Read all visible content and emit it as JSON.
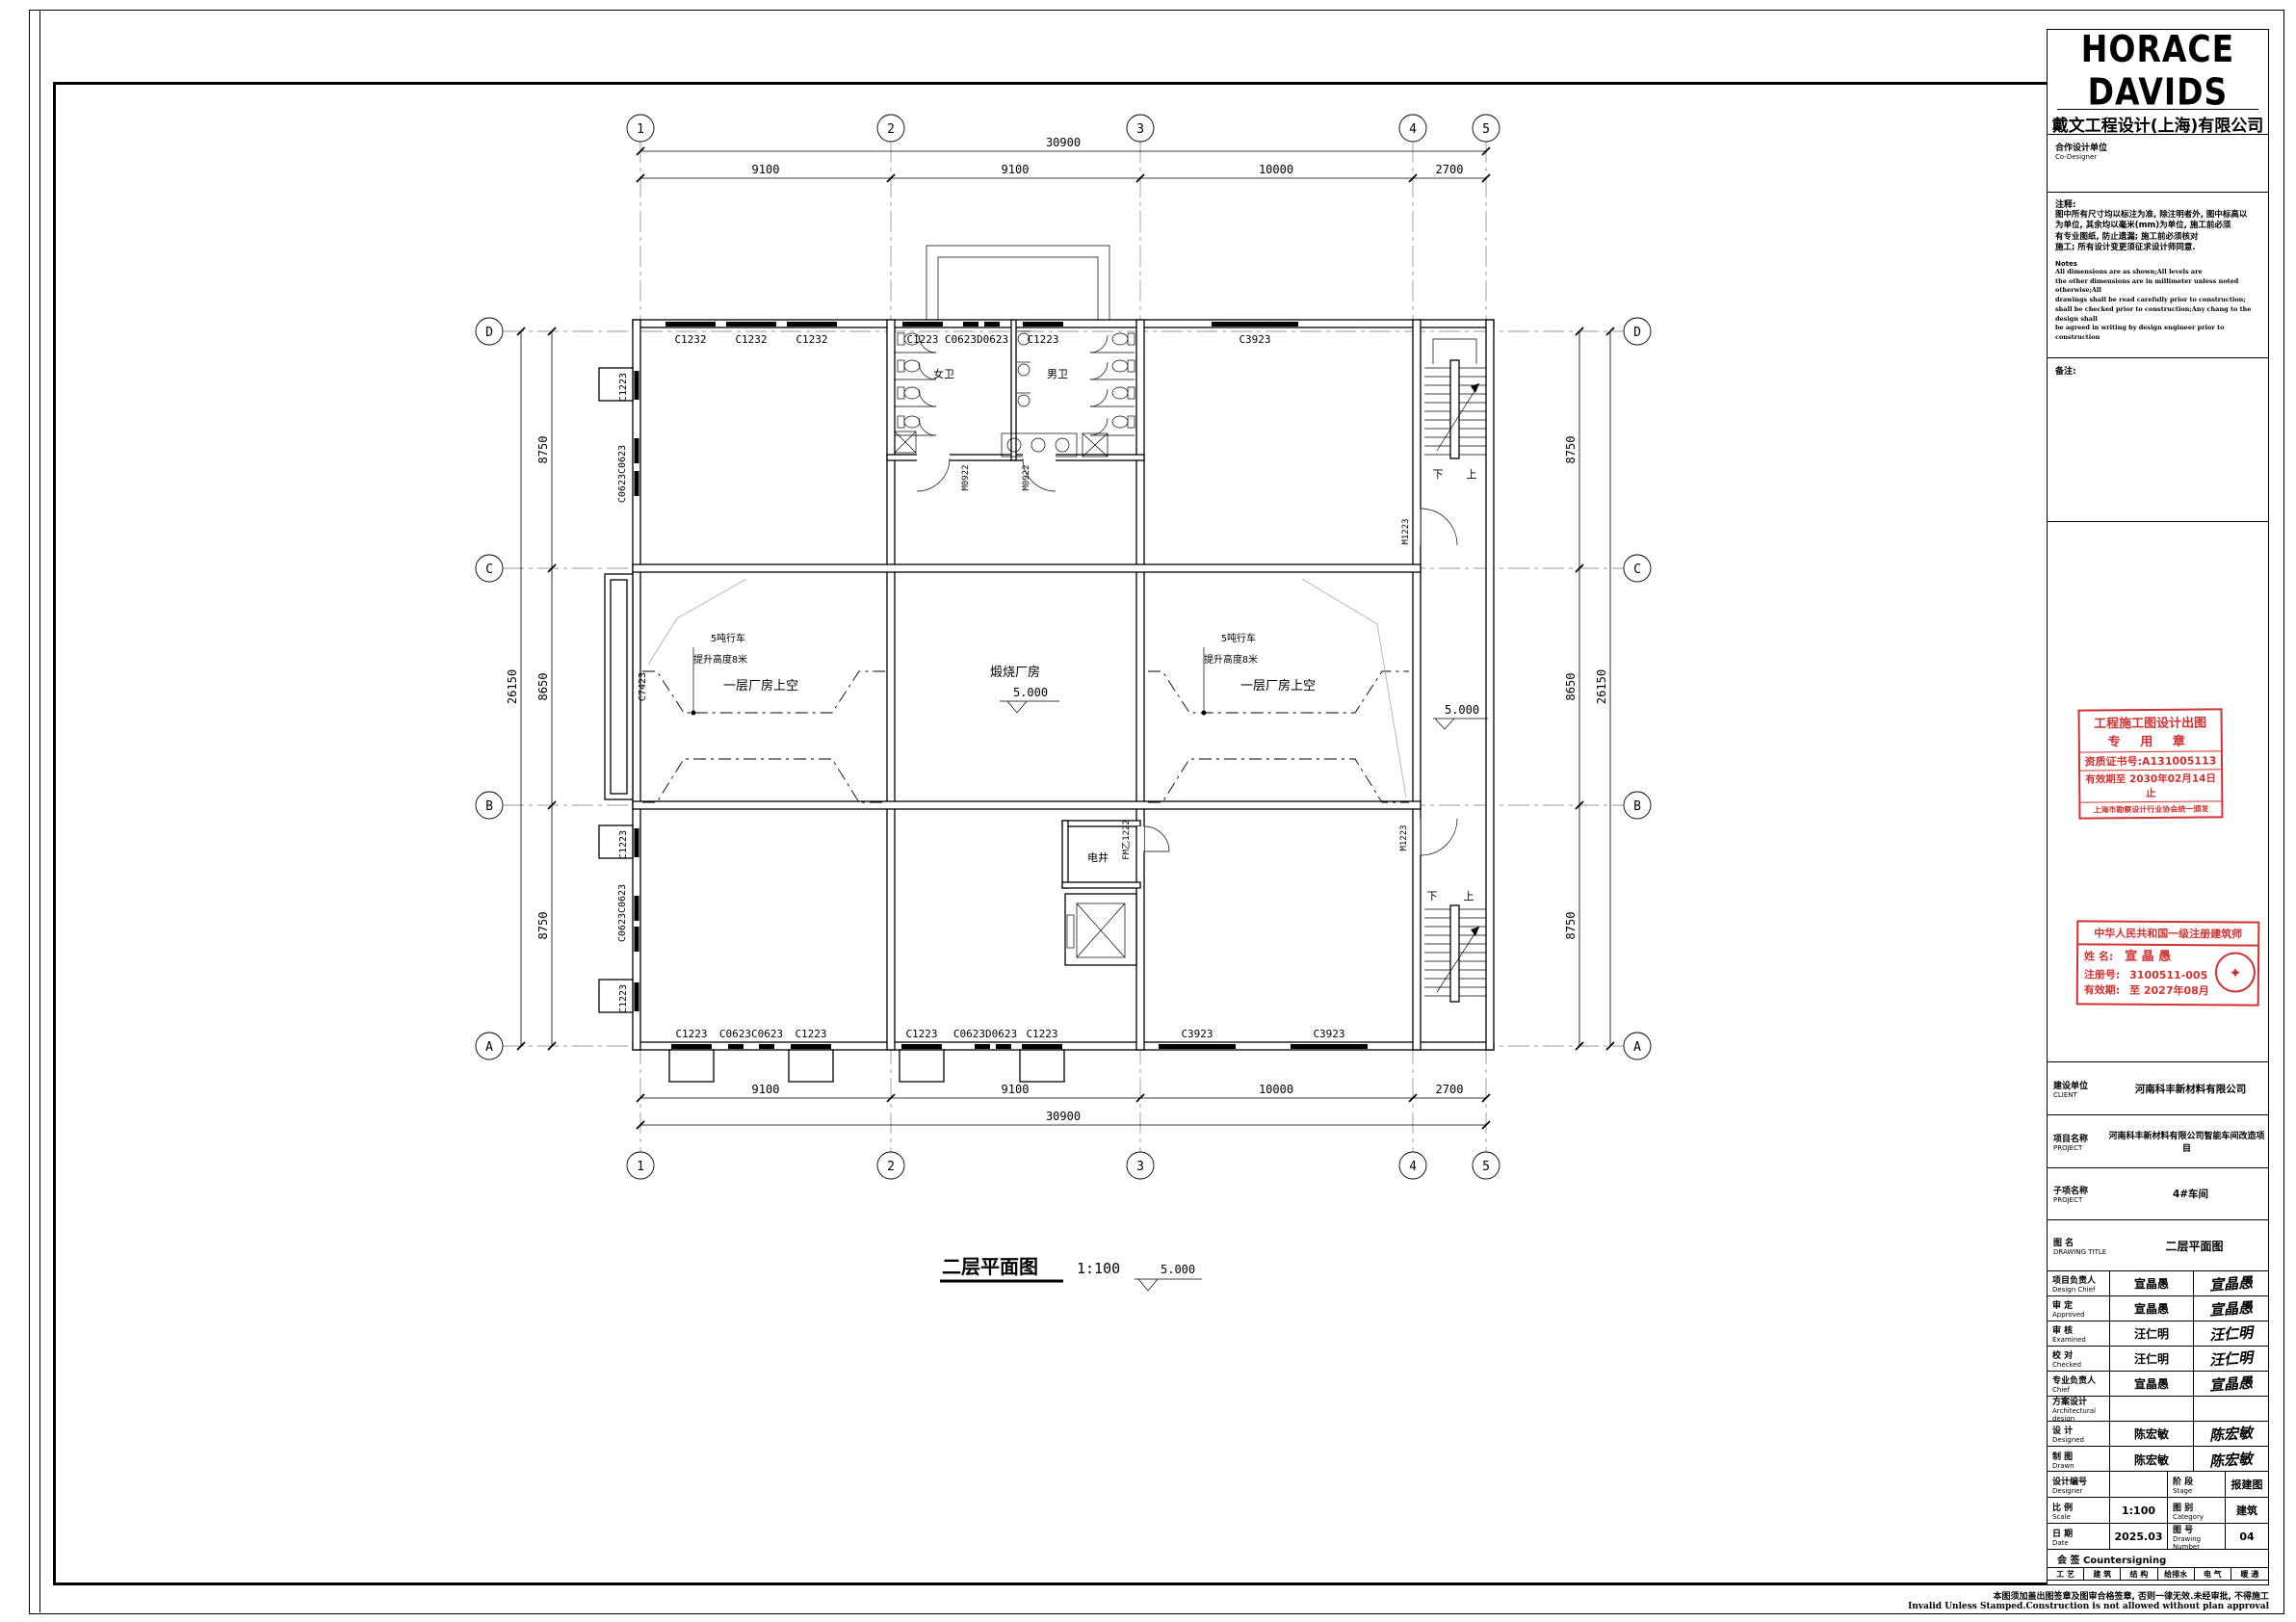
{
  "plan": {
    "grid_cols": [
      "1",
      "2",
      "3",
      "4",
      "5"
    ],
    "grid_rows": [
      "D",
      "C",
      "B",
      "A"
    ],
    "dim_total_h": "30900",
    "dim_segs_h": [
      "9100",
      "9100",
      "10000",
      "2700"
    ],
    "dim_total_v": "26150",
    "dim_segs_v": [
      "8750",
      "8650",
      "8750"
    ],
    "win_top": [
      "C1232",
      "C1232",
      "C1232",
      "C1223",
      "C0623D0623",
      "C1223",
      "C3923"
    ],
    "win_bottom": [
      "C1223",
      "C0623C0623",
      "C1223",
      "C1223",
      "C0623D0623",
      "C1223",
      "C3923",
      "C3923"
    ],
    "win_left": [
      "C1223",
      "C0623C0623",
      "C7423",
      "C1223",
      "C0623C0623",
      "C1223"
    ],
    "doors": {
      "m0922": "M0922",
      "m1223": "M1223",
      "fm": "FM乙1222"
    },
    "rooms": {
      "women": "女卫",
      "men": "男卫",
      "shaft": "电井",
      "kiln": "煅烧厂房",
      "void": "一层厂房上空"
    },
    "crane1": "5吨行车",
    "crane2": "提升高度8米",
    "level": "5.000",
    "stair_down": "下",
    "stair_up": "上",
    "title": "二层平面图",
    "scale": "1:100"
  },
  "titleblock": {
    "logo": "HORACE DAVIDS",
    "company_cn": "戴文工程设计(上海)有限公司",
    "company_en": "Davids Engineering Shanghai Co., Ltd.",
    "cert_no": "证书编号: A231005110",
    "co_cn": "合作设计单位",
    "co_en": "Co-Designer",
    "notes_cn_title": "注释:",
    "notes_cn1": "图中所有尺寸均以标注为准, 除注明者外, 图中标高以",
    "notes_cn2": "为单位, 其余均以毫米(mm)为单位, 施工前必须",
    "notes_cn3": "有专业图纸, 防止遗漏; 施工前必须核对",
    "notes_cn4": "施工; 所有设计变更须征求设计师同意.",
    "notes_en_title": "Notes",
    "notes_en1": "All dimensions are as shown;All levels are",
    "notes_en2": "the other dimensions are in millimeter unless noted otherwise;All",
    "notes_en3": "drawings shall be read carefully prior to construction;",
    "notes_en4": "shall be checked prior to construction;Any chang to the design shall",
    "notes_en5": "be agreed in writing by design engineer prior to construction",
    "remark": "备注:",
    "stamp1": {
      "line1": "工程施工图设计出图",
      "line2": "专  用  章",
      "line3": "资质证书号:A131005113",
      "line4": "有效期至 2030年02月14日止",
      "line5": "上海市勘察设计行业协会统一颁发"
    },
    "stamp2": {
      "title": "中华人民共和国一级注册建筑师",
      "name_label": "姓  名:",
      "name": "宣 晶 愚",
      "reg_label": "注册号:",
      "reg": "3100511-005",
      "valid_label": "有效期:",
      "valid": "至 2027年08月"
    },
    "client_cn": "建设单位",
    "client_en": "CLIENT",
    "client": "河南科丰新材料有限公司",
    "project_cn": "项目名称",
    "project_en": "PROJECT",
    "project": "河南科丰新材料有限公司智能车间改造项目",
    "sub_cn": "子项名称",
    "sub_en": "PROJECT",
    "sub": "4#车间",
    "dt_cn": "图  名",
    "dt_en": "DRAWING TITLE",
    "dt": "二层平面图",
    "rows": [
      {
        "cn": "项目负责人",
        "en": "Design Chief",
        "name": "宣晶愚",
        "sig": "宣晶愚"
      },
      {
        "cn": "审  定",
        "en": "Approved",
        "name": "宣晶愚",
        "sig": "宣晶愚"
      },
      {
        "cn": "审  核",
        "en": "Examined",
        "name": "汪仁明",
        "sig": "汪仁明"
      },
      {
        "cn": "校  对",
        "en": "Checked",
        "name": "汪仁明",
        "sig": "汪仁明"
      },
      {
        "cn": "专业负责人",
        "en": "Chief",
        "name": "宣晶愚",
        "sig": "宣晶愚"
      },
      {
        "cn": "方案设计",
        "en": "Architectural design",
        "name": "",
        "sig": ""
      },
      {
        "cn": "设  计",
        "en": "Designed",
        "name": "陈宏敏",
        "sig": "陈宏敏"
      },
      {
        "cn": "制  图",
        "en": "Drawn",
        "name": "陈宏敏",
        "sig": "陈宏敏"
      }
    ],
    "meta": {
      "no_cn": "设计编号",
      "no_en": "Designer",
      "no": "",
      "stage_cn": "阶  段",
      "stage_en": "Stage",
      "stage": "报建图",
      "scale_cn": "比  例",
      "scale_en": "Scale",
      "scale": "1:100",
      "cat_cn": "图  别",
      "cat_en": "Category",
      "cat": "建筑",
      "date_cn": "日  期",
      "date_en": "Date",
      "date": "2025.03",
      "num_cn": "图  号",
      "num_en": "Drawing Number",
      "num": "04"
    },
    "countersign": "会  签  Countersigning",
    "cs": [
      "工 艺",
      "建 筑",
      "结 构",
      "给排水",
      "电 气",
      "暖 通"
    ],
    "footer_cn": "本图须加盖出图签章及图审合格签章, 否则一律无效.未经审批, 不得施工",
    "footer_en": "Invalid Unless Stamped.Construction is not allowed without plan approval"
  }
}
